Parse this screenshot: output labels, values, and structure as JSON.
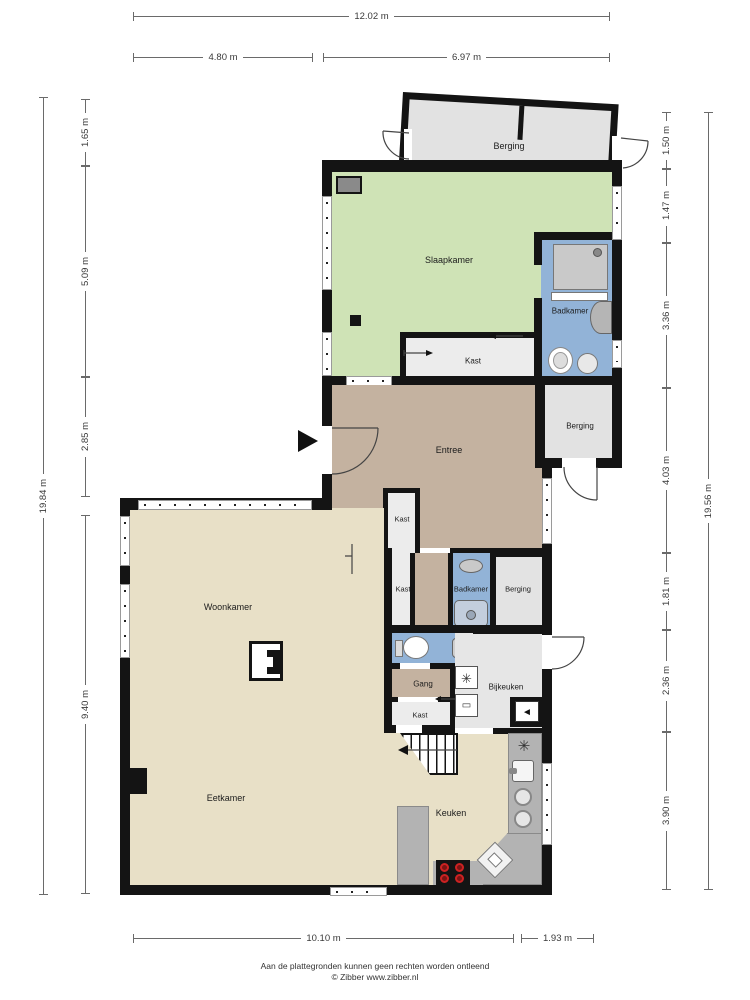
{
  "dims": {
    "top": {
      "total": "12.02 m",
      "a": "4.80 m",
      "b": "6.97 m"
    },
    "left": {
      "total": "19.84 m",
      "a": "1.65 m",
      "b": "5.09 m",
      "c": "2.85 m",
      "d": "9.40 m"
    },
    "right": {
      "total": "19.56 m",
      "a": "1.50 m",
      "b": "1.47 m",
      "c": "3.36 m",
      "d": "4.03 m",
      "e": "1.81 m",
      "f": "2.36 m",
      "g": "3.90 m"
    },
    "bottom": {
      "a": "10.10 m",
      "b": "1.93 m"
    }
  },
  "rooms": {
    "berging_top": "Berging",
    "slaapkamer": "Slaapkamer",
    "badkamer_top": "Badkamer",
    "kast_slaapkamer": "Kast",
    "berging_mid": "Berging",
    "entree": "Entree",
    "kast_entree": "Kast",
    "woonkamer": "Woonkamer",
    "kast_hal": "Kast",
    "badkamer_mid": "Badkamer",
    "berging_klein": "Berging",
    "gang": "Gang",
    "kast_gang": "Kast",
    "bijkeuken": "Bijkeuken",
    "eetkamer": "Eetkamer",
    "keuken": "Keuken"
  },
  "icons": {
    "washing_machine_glyph": "✳",
    "appliance_glyph": "▭",
    "vent_glyph": "◄",
    "extractor_glyph": "✳"
  },
  "colors": {
    "wall": "#141414",
    "slaapkamer": "#cfe3b6",
    "badkamer": "#92b3d7",
    "entree_gang": "#c4b2a0",
    "leefruimte": "#e8e0c7",
    "berging": "#e2e2e2",
    "kast": "#ececec",
    "counter": "#b3b3b3",
    "cooktop_burner": "#cc2222"
  },
  "footer": {
    "line1": "Aan de plattegronden kunnen geen rechten worden ontleend",
    "line2": "© Zibber www.zibber.nl"
  }
}
